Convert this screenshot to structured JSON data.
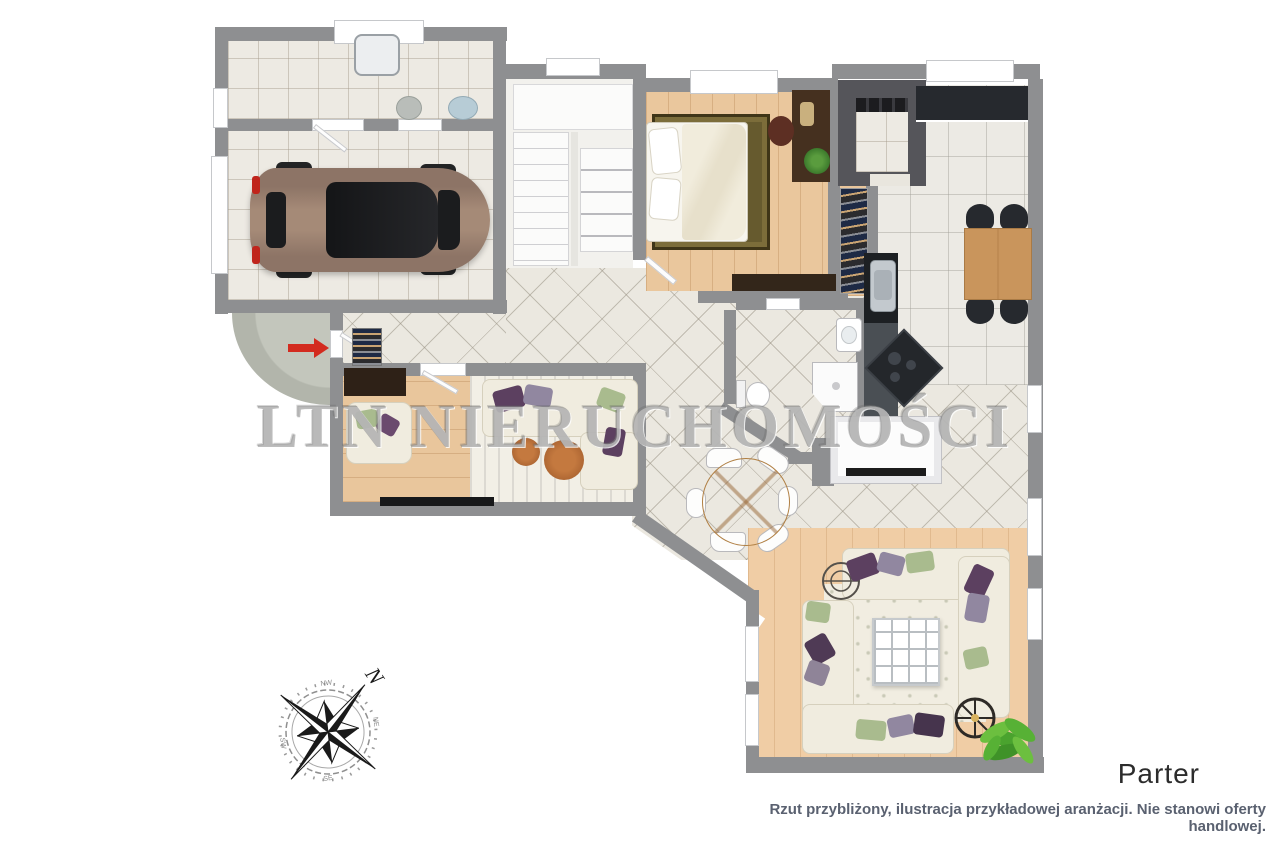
{
  "watermark": {
    "text": "LTN NIERUCHOMOŚCI"
  },
  "floor_label": "Parter",
  "disclaimer": "Rzut przybliżony, ilustracja przykładowej aranżacji. Nie stanowi oferty handlowej.",
  "compass": {
    "primary": "N",
    "minor": [
      "NW",
      "NE",
      "SE",
      "SW"
    ]
  },
  "icons": {
    "compass_rose": "8-point star compass tilted north-east",
    "entry_arrow": "red right-pointing entrance arrow"
  },
  "colors": {
    "wall_gray": "#8e8f91",
    "tile_floor": "#edeae3",
    "hall_tile": "#ebe8e0",
    "wood_floor": "#eac79d",
    "living_wood": "#f0cda5",
    "sofa_cream": "#f0ecdf",
    "accent_purple": "#5c4060",
    "accent_green": "#a9bb8e",
    "counter_dark": "#26292e",
    "table_wood": "#cf9a5f",
    "car_brown": "#977d6c",
    "arrow_red": "#d32b1f",
    "watermark_gray": "#8a8a8a",
    "disclaimer_gray": "#5a6170"
  }
}
